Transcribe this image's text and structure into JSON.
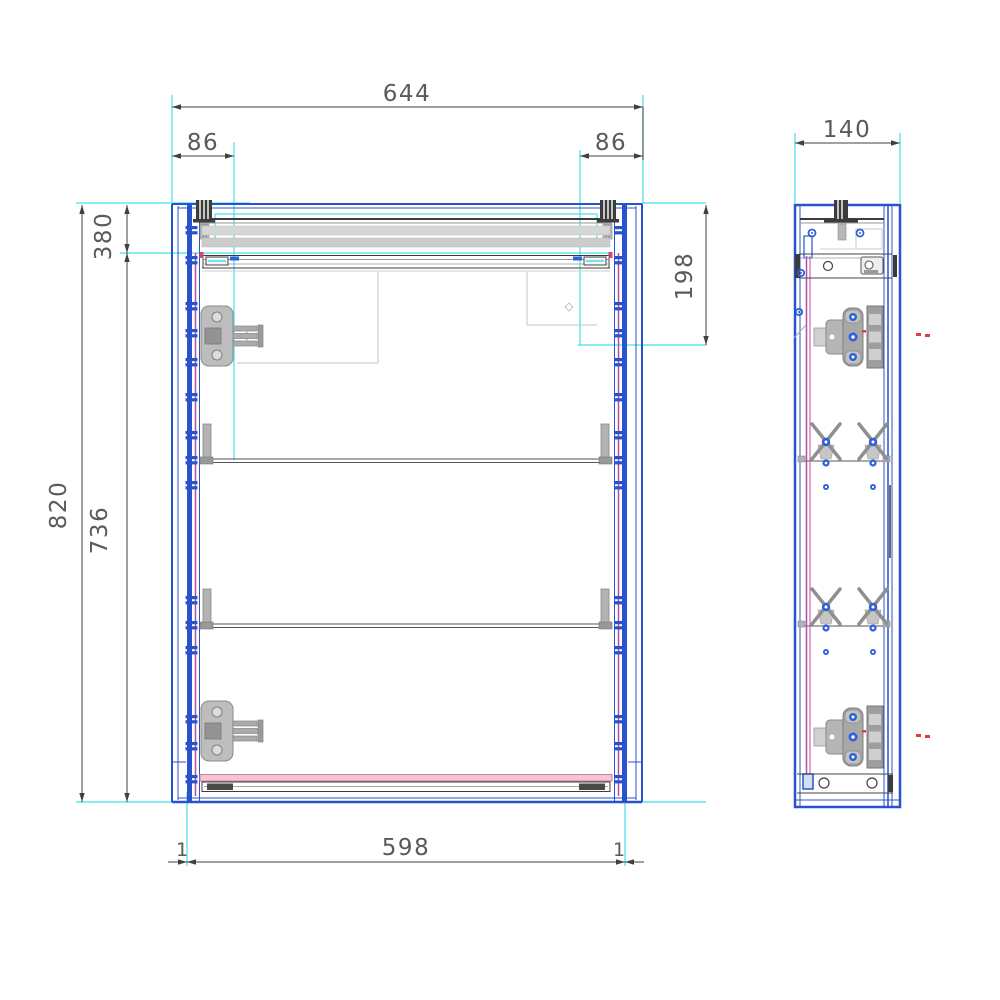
{
  "drawing": {
    "title": "Cabinet technical drawing - front and side views",
    "front_view": {
      "dim_overall_width": "644",
      "dim_left_offset": "86",
      "dim_right_offset": "86",
      "dim_top_section_height": "198",
      "dim_back_rail": "380",
      "dim_overall_height": "820",
      "dim_interior_height": "736",
      "dim_bottom_width": "598",
      "dim_gap_left": "1",
      "dim_gap_right": "1"
    },
    "side_view": {
      "dim_depth": "140"
    },
    "colors": {
      "outline_blue": "#2853cc",
      "construction_cyan": "#45e0ec",
      "back_panel_magenta": "#b44fa0",
      "bottom_strip_pink": "#f6c4d2",
      "hardware_gray": "#b5b5b5",
      "marker_red": "#e03c3c",
      "dimension_gray": "#5a5a5a"
    }
  }
}
